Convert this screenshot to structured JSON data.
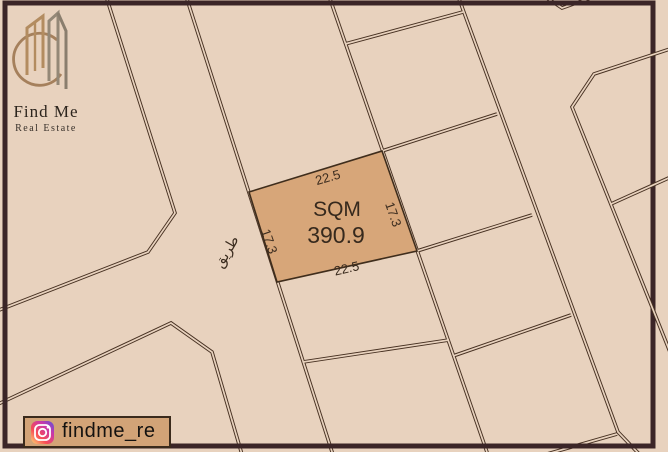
{
  "brand": {
    "name": "Find Me",
    "subtitle": "Real Estate"
  },
  "plot": {
    "sqm_label": "SQM",
    "area_value": "390.9",
    "dim_top": "22.5",
    "dim_bottom": "22.5",
    "dim_left": "17.3",
    "dim_right": "17.3"
  },
  "road": {
    "name_ar": "طريق"
  },
  "social": {
    "platform": "instagram",
    "handle": "findme_re"
  },
  "colors": {
    "background": "#e8d2be",
    "line": "#473122",
    "frame": "#3b2527",
    "parcel_highlight": "#d7a679",
    "badge_background": "#d2a377",
    "logo_tan": "#b38c60",
    "logo_gray": "#8d8175"
  }
}
